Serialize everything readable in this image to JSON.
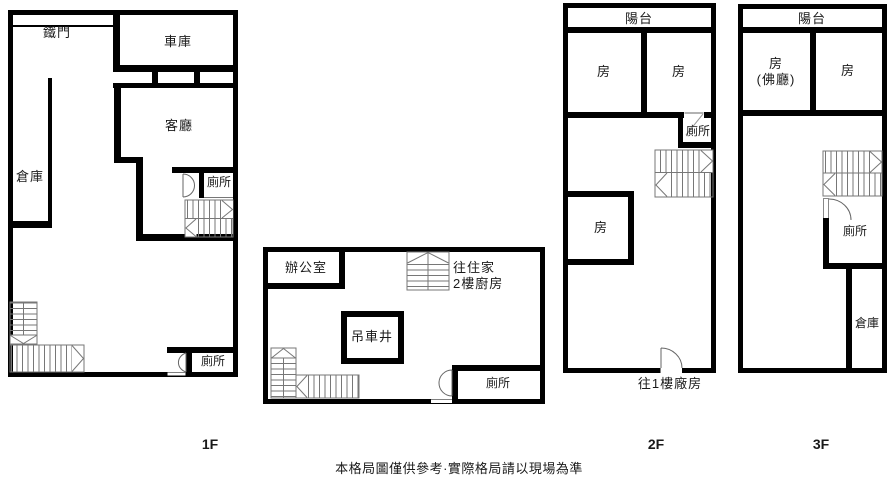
{
  "colors": {
    "wall": "#000000",
    "background": "#ffffff",
    "stair_line": "#777777"
  },
  "floor1": {
    "iron_gate": "鐵門",
    "garage": "車庫",
    "living_room": "客廳",
    "storage": "倉庫",
    "toilet_upper": "廁所",
    "toilet_lower": "廁所",
    "floor_label": "1F"
  },
  "annex": {
    "office": "辦公室",
    "stairs_note_line1": "往住家",
    "stairs_note_line2": "2樓廚房",
    "crane_shaft": "吊車井",
    "toilet": "廁所"
  },
  "floor2": {
    "balcony": "陽台",
    "room_left": "房",
    "room_right": "房",
    "toilet": "廁所",
    "room_lower": "房",
    "exit_note": "往1樓廠房",
    "floor_label": "2F"
  },
  "floor3": {
    "balcony": "陽台",
    "room_left_line1": "房",
    "room_left_line2": "(佛廳)",
    "room_right": "房",
    "toilet": "廁所",
    "storage": "倉庫",
    "floor_label": "3F"
  },
  "caption": "本格局圖僅供參考·實際格局請以現場為準"
}
